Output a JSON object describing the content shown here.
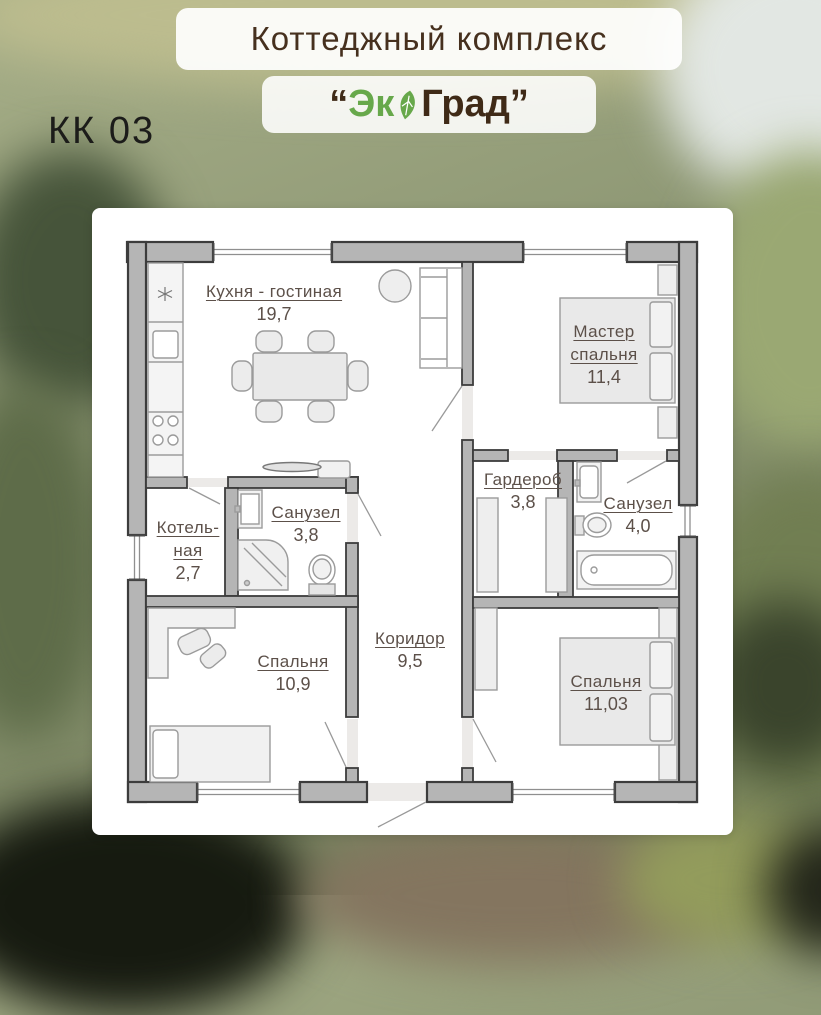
{
  "plan_code": "КК 03",
  "header": {
    "subtitle": "Коттеджный комплекс",
    "brand_quote_open": "“",
    "brand_eco": "Эк",
    "brand_grad": "Град",
    "brand_quote_close": "”",
    "leaf_icon": "leaf-icon"
  },
  "colors": {
    "brand_green": "#67a84b",
    "brand_brown": "#3f2a17",
    "label_text": "#5c5049",
    "wall_fill": "#b5b5b5",
    "wall_stroke": "#3c3c3c"
  },
  "rooms": [
    {
      "key": "kitchen-living",
      "name": "Кухня - гостиная",
      "area": "19,7"
    },
    {
      "key": "master-bedroom",
      "name": "Мастер",
      "name2": "спальня",
      "area": "11,4"
    },
    {
      "key": "wardrobe",
      "name": "Гардероб",
      "area": "3,8"
    },
    {
      "key": "bathroom-master",
      "name": "Санузел",
      "area": "4,0"
    },
    {
      "key": "boiler-room",
      "name": "Котель-",
      "name2": "ная",
      "area": "2,7"
    },
    {
      "key": "bathroom",
      "name": "Санузел",
      "area": "3,8"
    },
    {
      "key": "corridor",
      "name": "Коридор",
      "area": "9,5"
    },
    {
      "key": "bedroom-left",
      "name": "Спальня",
      "area": "10,9"
    },
    {
      "key": "bedroom-right",
      "name": "Спальня",
      "area": "11,03"
    }
  ]
}
